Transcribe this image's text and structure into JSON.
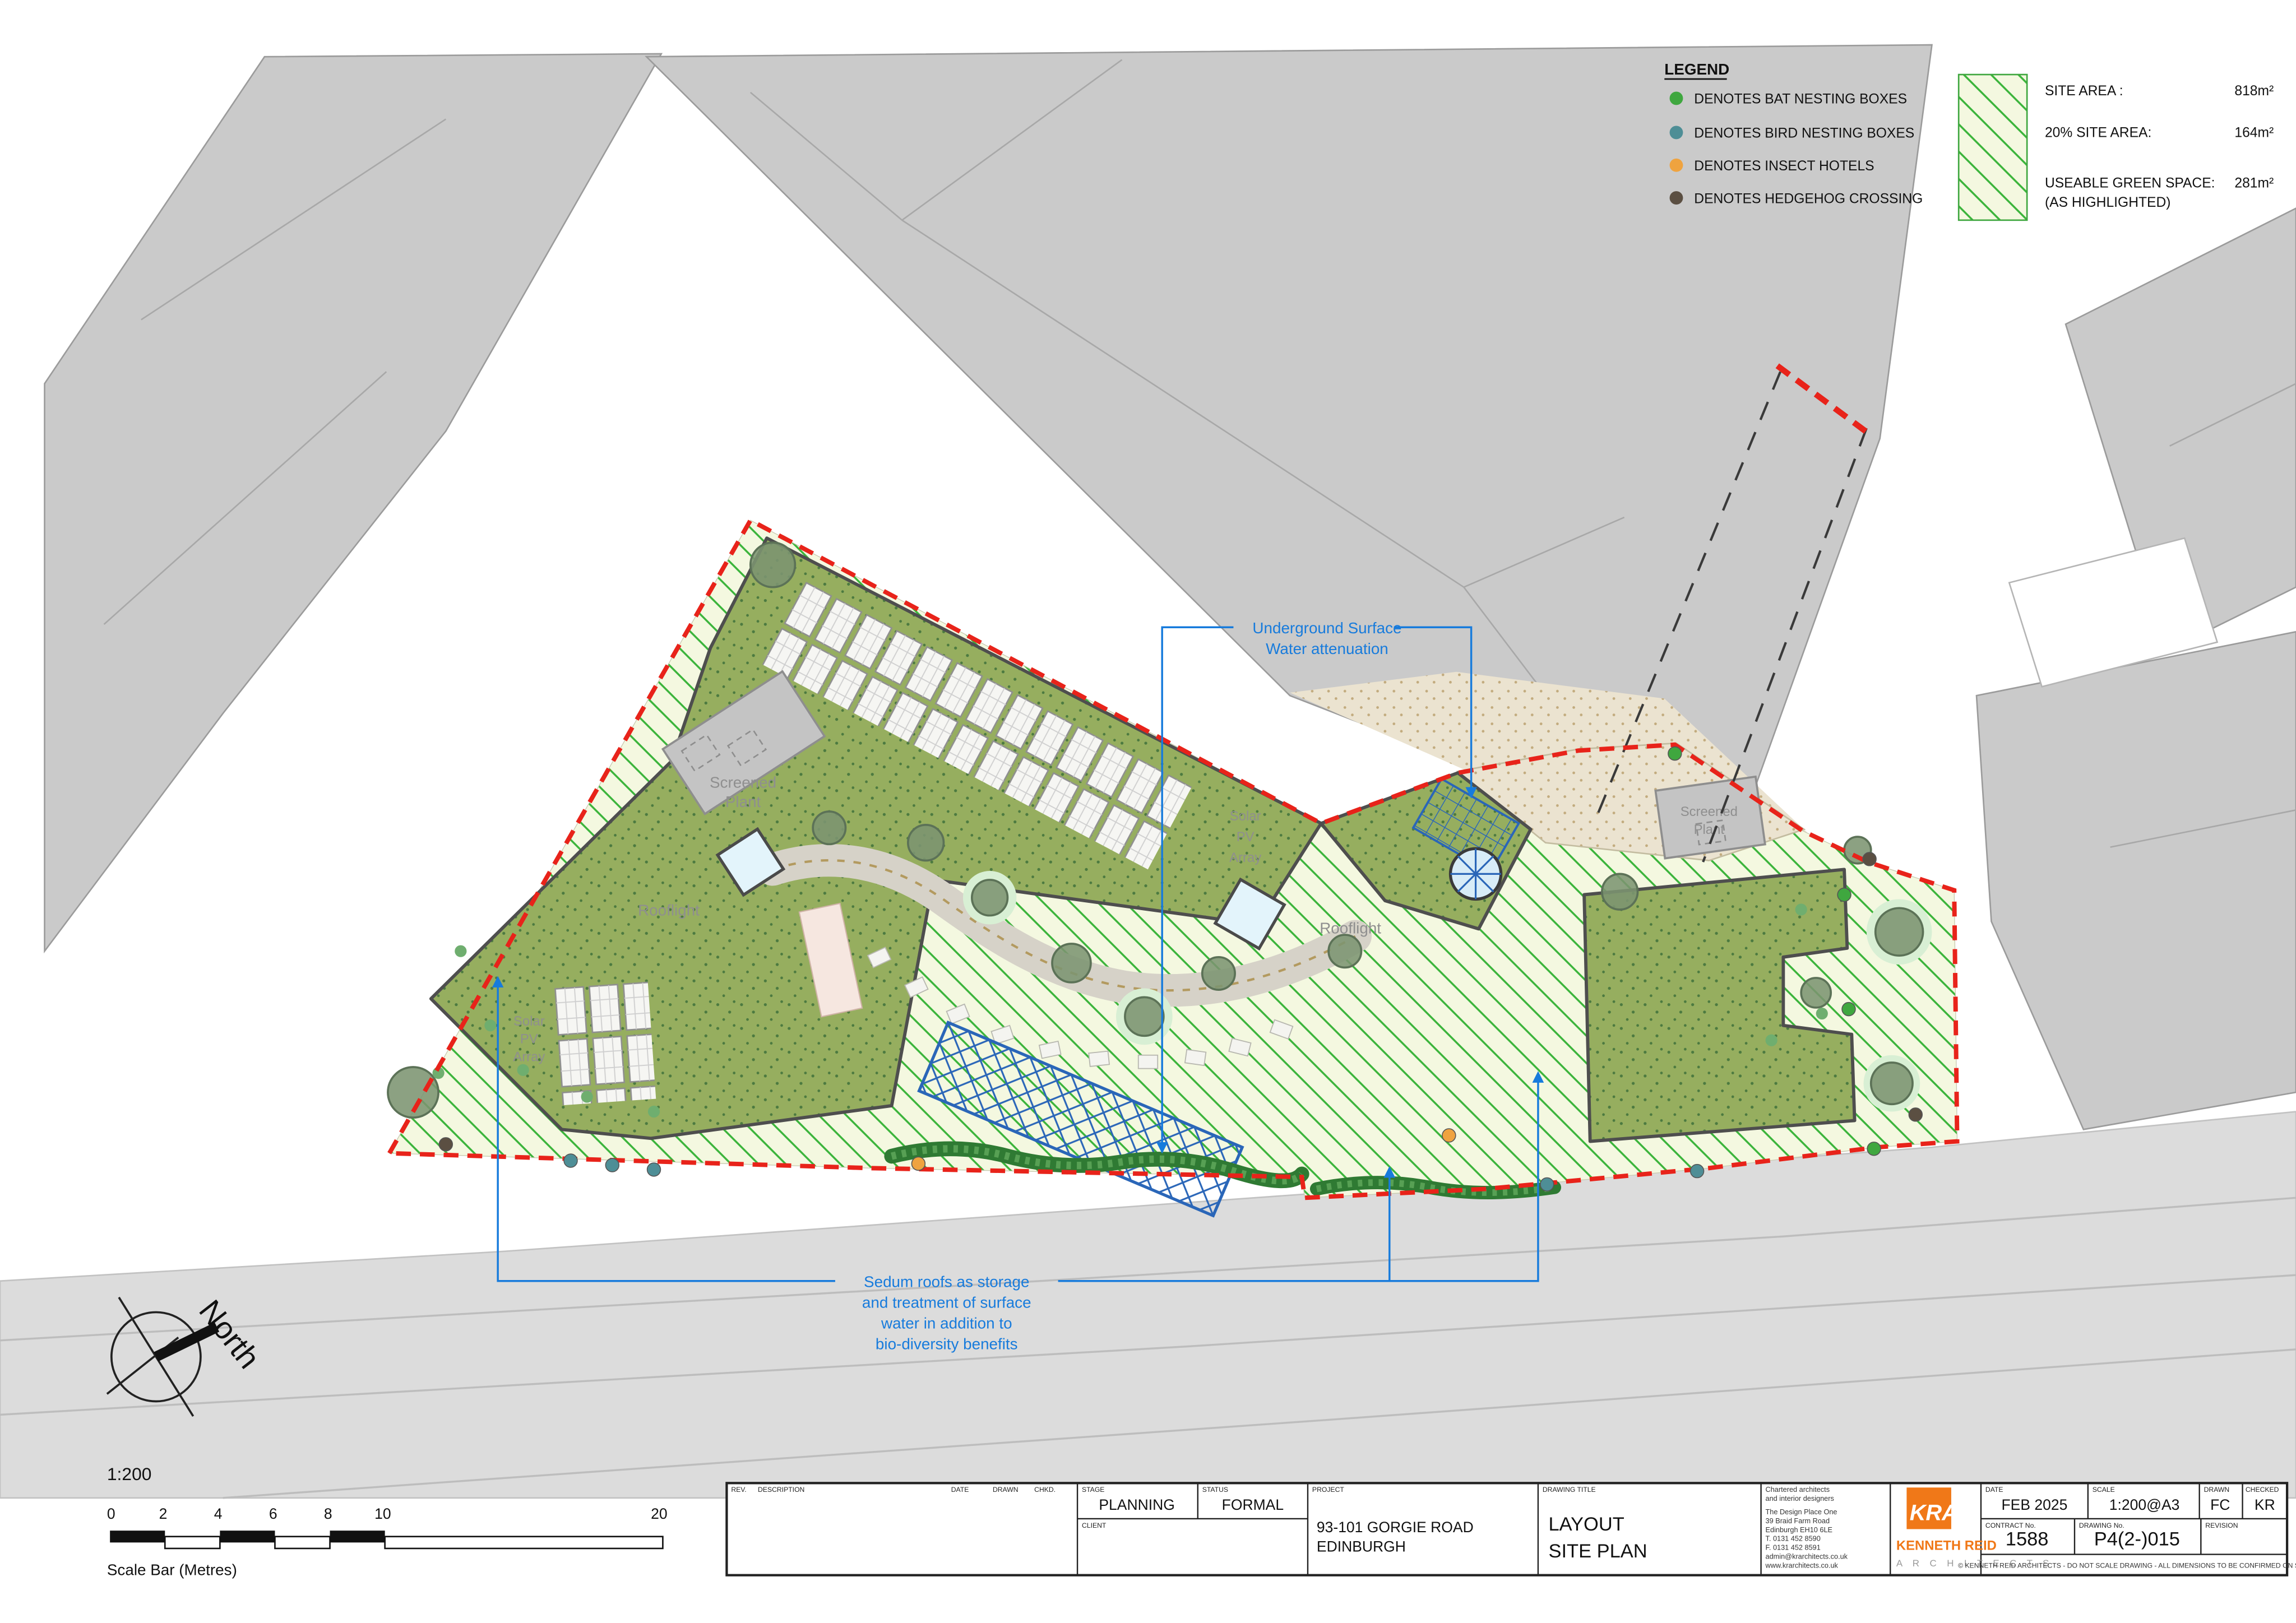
{
  "drawing": {
    "type": "architectural site plan",
    "colors": {
      "boundary_red": "#e8231a",
      "annotation_blue": "#177bdc",
      "pergola_blue": "#2a66b8",
      "sedum_green": "#96ae5f",
      "hatch_green": "#3bb43b",
      "neighbour_grey": "#cacaca",
      "road_grey": "#dcdcdc",
      "label_grey": "#8f8f8f",
      "logo_orange": "#f07818"
    }
  },
  "legend": {
    "title": "LEGEND",
    "items": [
      {
        "icon": "bat-nesting-box-dot",
        "color": "#3fa73f",
        "label": "DENOTES BAT NESTING BOXES"
      },
      {
        "icon": "bird-nesting-box-dot",
        "color": "#4e8e96",
        "label": "DENOTES BIRD NESTING BOXES"
      },
      {
        "icon": "insect-hotel-dot",
        "color": "#efa33f",
        "label": "DENOTES INSECT HOTELS"
      },
      {
        "icon": "hedgehog-crossing-dot",
        "color": "#5b4f42",
        "label": "DENOTES HEDGEHOG CROSSING"
      }
    ],
    "areas": [
      {
        "label": "SITE AREA :",
        "value": "818m²"
      },
      {
        "label": "20% SITE AREA:",
        "value": "164m²"
      },
      {
        "label": "USEABLE GREEN SPACE:",
        "value": "281m²"
      }
    ],
    "areas_note": "(AS HIGHLIGHTED)"
  },
  "annotations": {
    "attenuation_lines": [
      "Underground Surface",
      "Water attenuation"
    ],
    "sedum_lines": [
      "Sedum roofs as storage",
      "and treatment of surface",
      "water in addition to",
      "bio-diversity benefits"
    ]
  },
  "plan_labels": {
    "screened_plant_1": "Screened",
    "screened_plant_2": "Plant",
    "rooflight": "Rooflight",
    "solar_1": "Solar",
    "solar_2": "PV",
    "solar_3": "Array",
    "north": "North"
  },
  "scale_bar": {
    "ratio": "1:200",
    "ticks": [
      "0",
      "2",
      "4",
      "6",
      "8",
      "10",
      "20"
    ],
    "caption": "Scale Bar (Metres)"
  },
  "title_block": {
    "headers": {
      "rev": "REV.",
      "description": "DESCRIPTION",
      "date": "DATE",
      "drawn": "DRAWN",
      "chkd": "CHKD.",
      "stage": "STAGE",
      "status": "STATUS",
      "client": "CLIENT",
      "project": "PROJECT",
      "drawing_title": "DRAWING TITLE",
      "date2": "DATE",
      "scale": "SCALE",
      "drawn2": "DRAWN",
      "checked": "CHECKED",
      "contract_no": "CONTRACT No.",
      "drawing_no": "DRAWING No.",
      "revision": "REVISION"
    },
    "stage_value": "PLANNING",
    "status_value": "FORMAL",
    "project_line1": "93-101 GORGIE ROAD",
    "project_line2": "EDINBURGH",
    "title_line1": "LAYOUT",
    "title_line2": "SITE PLAN",
    "architect_lines": [
      "Chartered architects",
      "and interior designers",
      "The Design Place One",
      "39 Braid Farm Road",
      "Edinburgh EH10 6LE",
      "T. 0131 452 8590",
      "F. 0131 452 8591",
      "admin@krarchitects.co.uk",
      "www.krarchitects.co.uk"
    ],
    "logo": {
      "monogram": "KRA",
      "name": "KENNETH REID",
      "sub": "A R C H I T E C T S"
    },
    "date_value": "FEB 2025",
    "scale_value": "1:200@A3",
    "drawn_value": "FC",
    "checked_value": "KR",
    "contract_value": "1588",
    "drawing_no_value": "P4(2-)015",
    "revision_value": "",
    "copyright": "© KENNETH REID ARCHITECTS - DO NOT SCALE DRAWING - ALL DIMENSIONS TO BE CONFIRMED ON SITE"
  }
}
